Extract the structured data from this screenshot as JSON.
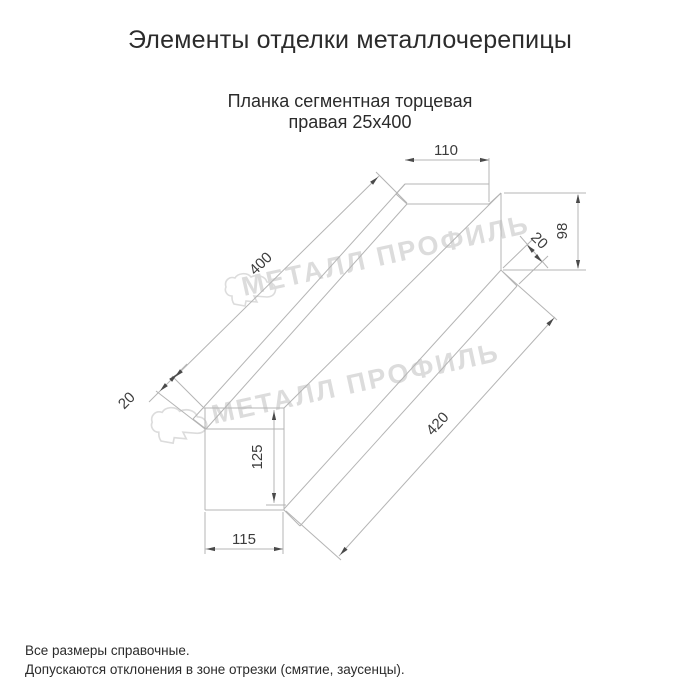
{
  "title": "Элементы отделки металлочерепицы",
  "subtitle": {
    "line1": "Планка сегментная торцевая",
    "line2": "правая 25х400"
  },
  "drawing": {
    "part_name": "Планка сегментная торцевая правая 25х400",
    "dims": {
      "top_width": "110",
      "right_height": "98",
      "right_fold": "20",
      "top_edge_length": "400",
      "bottom_edge_length": "420",
      "left_fold": "20",
      "left_height": "125",
      "bottom_width": "115"
    }
  },
  "watermark": {
    "text": "МЕТАЛЛ ПРОФИЛЬ",
    "logo": "metall-profil-cloud-logo"
  },
  "notes": {
    "line1": "Все размеры справочные.",
    "line2": "Допускаются отклонения в зоне отрезки (смятие, заусенцы)."
  },
  "colors": {
    "background": "#ffffff",
    "line": "#b4b4b4",
    "dim_text": "#3c3c3c",
    "arrow": "#4a4a4a",
    "text": "#2b2b2b",
    "watermark": "#dcdcdc"
  }
}
